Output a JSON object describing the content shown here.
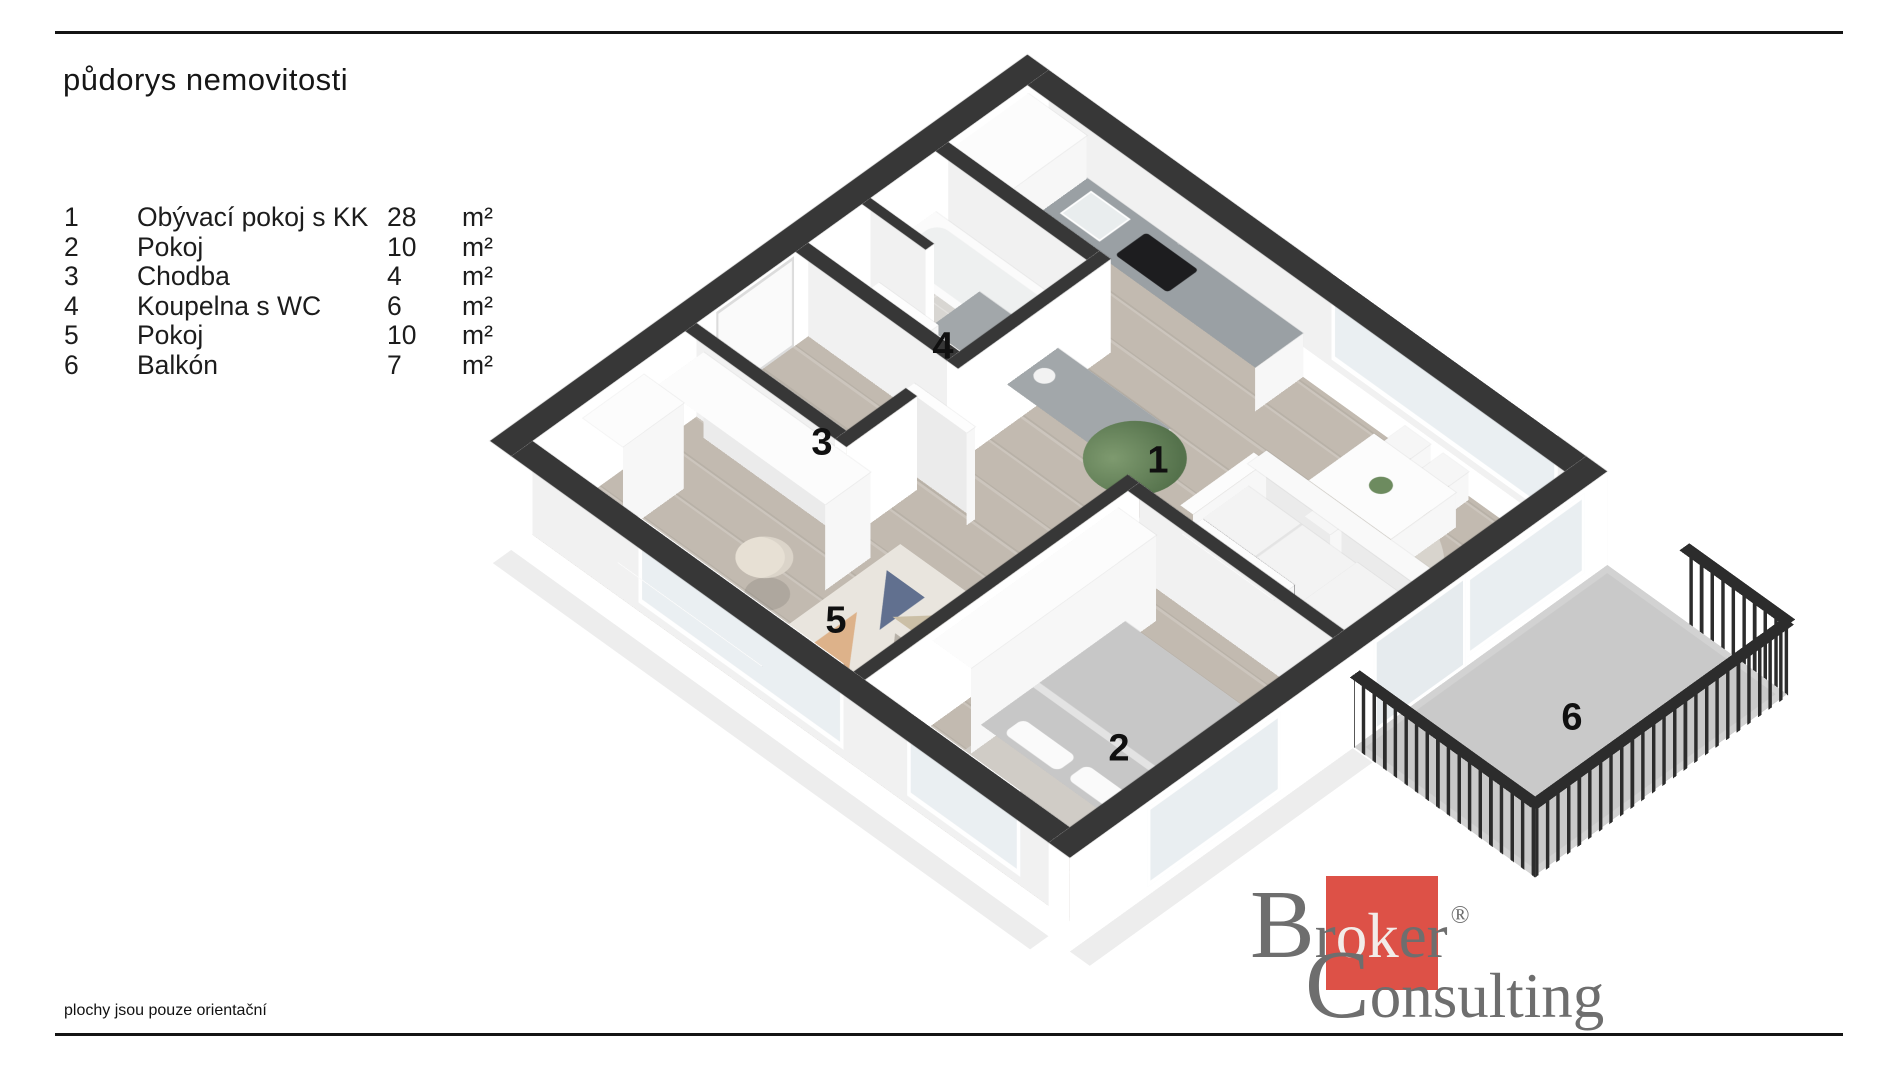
{
  "title": "půdorys nemovitosti",
  "legend": {
    "rows": [
      {
        "num": "1",
        "name": "Obývací pokoj s KK",
        "value": "28",
        "unit": "m²"
      },
      {
        "num": "2",
        "name": "Pokoj",
        "value": "10",
        "unit": "m²"
      },
      {
        "num": "3",
        "name": "Chodba",
        "value": "4",
        "unit": "m²"
      },
      {
        "num": "4",
        "name": "Koupelna s WC",
        "value": "6",
        "unit": "m²"
      },
      {
        "num": "5",
        "name": "Pokoj",
        "value": "10",
        "unit": "m²"
      },
      {
        "num": "6",
        "name": "Balkón",
        "value": "7",
        "unit": "m²"
      }
    ]
  },
  "note": "plochy jsou pouze orientační",
  "logo": {
    "top_initial": "B",
    "top_rest": "r",
    "top_ok": "ok",
    "top_end": "er",
    "registered": "®",
    "bottom_initial": "C",
    "bottom_rest": "onsulting"
  },
  "colors": {
    "wall_top": "#373737",
    "wood_floor": "#c2bab0",
    "bath_tile": "#d8d6d2",
    "balcony_floor": "#c9c9c9",
    "counter_gray": "#9aa0a4",
    "brand_red": "#dd5147",
    "logo_gray": "#6e6e6e",
    "railing_dark": "#2c2c2c"
  }
}
